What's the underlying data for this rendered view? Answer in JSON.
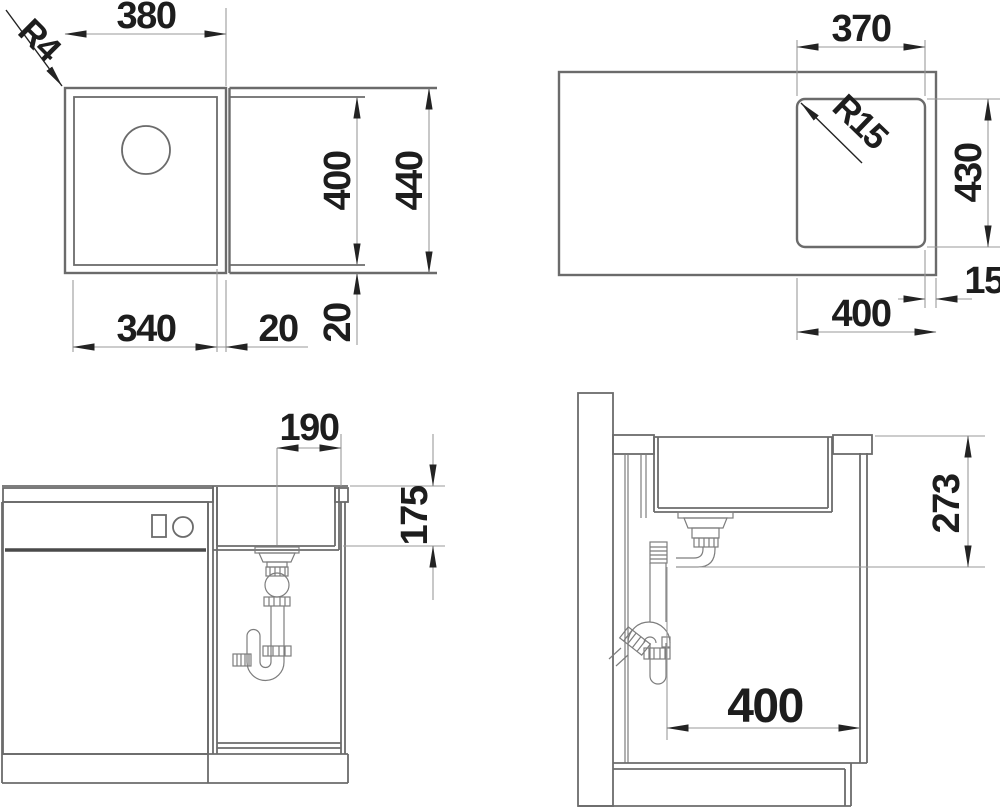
{
  "drawing": {
    "title": "Undermount sink installation dimension drawing",
    "views": {
      "plan": {
        "overall_width": "380",
        "corner_radius": "R4",
        "bowl_depth": "400",
        "overall_depth": "440",
        "bowl_width": "340",
        "rim_side": "20",
        "rim_back": "20"
      },
      "cutout": {
        "width": "370",
        "corner_radius": "R15",
        "height": "430",
        "edge_gap": "15",
        "offset": "400"
      },
      "front_section": {
        "drain_offset": "190",
        "bowl_depth": "175"
      },
      "side_section": {
        "outlet_height": "273",
        "outlet_offset": "400"
      }
    },
    "colors": {
      "object_line": "#6b6b6b",
      "dimension_line": "#9a9a9a",
      "ink": "#232323",
      "background": "#ffffff"
    }
  }
}
